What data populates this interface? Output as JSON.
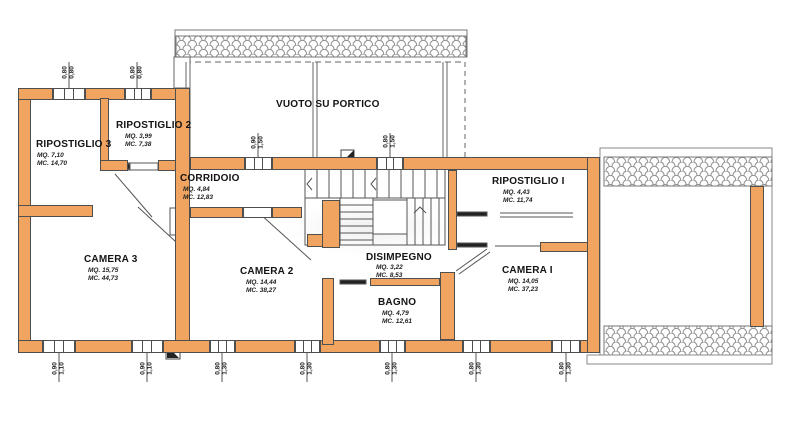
{
  "plan": {
    "portico_label": "VUOTO SU PORTICO",
    "colors": {
      "wall": "#f1a45f",
      "outline": "#4f4f4f",
      "hatch": "#8f8f8f",
      "text": "#141414"
    },
    "rooms": [
      {
        "name": "RIPOSTIGLIO 3",
        "mq": "MQ. 7,10",
        "mc": "MC. 14,70"
      },
      {
        "name": "RIPOSTIGLIO 2",
        "mq": "MQ. 3,99",
        "mc": "MC. 7,38"
      },
      {
        "name": "CORRIDOIO",
        "mq": "MQ. 4,84",
        "mc": "MC. 12,83"
      },
      {
        "name": "RIPOSTIGLIO I",
        "mq": "MQ. 4,43",
        "mc": "MC. 11,74"
      },
      {
        "name": "CAMERA 3",
        "mq": "MQ. 15,75",
        "mc": "MC. 44,73"
      },
      {
        "name": "CAMERA 2",
        "mq": "MQ. 14,44",
        "mc": "MC. 38,27"
      },
      {
        "name": "DISIMPEGNO",
        "mq": "MQ. 3,22",
        "mc": "MC. 8,53"
      },
      {
        "name": "BAGNO",
        "mq": "MQ. 4,79",
        "mc": "MC. 12,61"
      },
      {
        "name": "CAMERA I",
        "mq": "MQ. 14,05",
        "mc": "MC. 37,23"
      }
    ],
    "dims": [
      {
        "w": "0,80",
        "h": "0,80"
      },
      {
        "w": "0,80",
        "h": "0,80"
      },
      {
        "w": "0,90",
        "h": "1,50"
      },
      {
        "w": "0,80",
        "h": "1,50"
      },
      {
        "w": "0,90",
        "h": "1,10"
      },
      {
        "w": "0,90",
        "h": "1,10"
      },
      {
        "w": "0,80",
        "h": "1,30"
      },
      {
        "w": "0,80",
        "h": "1,30"
      },
      {
        "w": "0,80",
        "h": "1,30"
      },
      {
        "w": "0,80",
        "h": "1,30"
      },
      {
        "w": "0,80",
        "h": "1,30"
      }
    ]
  }
}
